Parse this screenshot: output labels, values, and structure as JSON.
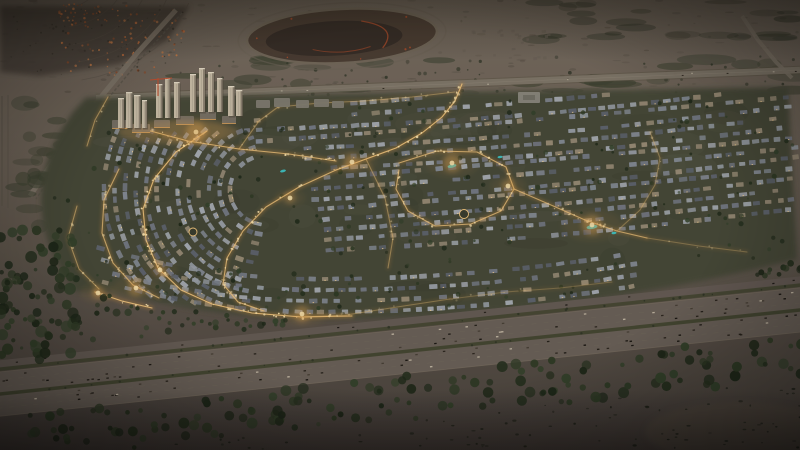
{
  "image": {
    "kind": "aerial-photograph-render",
    "subject": "illuminated master-planned villa community at dusk",
    "environment": "desert plain, dirt oval track at top, multi-lane highway and tree belt in foreground",
    "width": 800,
    "height": 450
  },
  "palette": {
    "desert_top": "#776c60",
    "desert_mid": "#6e6357",
    "desert_low": "#5e554b",
    "desert_bottom": "#49413c",
    "desert_speckle": "#3e382e",
    "scrub_green": "#3d4230",
    "scrub_dark": "#2d3324",
    "distant_base": "#4a4138",
    "distant_roofs": [
      "#c4703f",
      "#a85c33",
      "#8f4f2e",
      "#d08049"
    ],
    "track_ring": "#756a5b",
    "track_fill": "#4a3c32",
    "track_inner": "#382e28",
    "track_accent": "#b44f2c",
    "road_gray": "#83796c",
    "road_edge": "#948a7c",
    "rail_gray": "#5d564b",
    "community_ground": "#474a38",
    "ground_light": "#565947",
    "ground_dark": "#3a3d2e",
    "warm_ground": "#8a703f",
    "roof_grays": [
      "#9aa0a8",
      "#868c96",
      "#767b86",
      "#a8adb4",
      "#5f646e",
      "#9a8d77"
    ],
    "window_warm": "#ffd894",
    "street_amber": "#c98f3f",
    "street_bright": "#ffcf82",
    "street_dot": "#ffe7b0",
    "glow_amber": "#e8a855",
    "tree_greens": [
      "#26301e",
      "#1e2818",
      "#2e3a24",
      "#34422a"
    ],
    "pool_teal": "#3fc8c8",
    "tower_light": "#cbbfa9",
    "tower_shade": "#8d8271",
    "tower_cap": "#e6ddc8",
    "podium": "#7b7366",
    "midrise": "#827d72",
    "school": "#8d8a80",
    "crane_red": "#c9502e",
    "asphalt": "#6b6158",
    "asphalt_edge": "#7d7264",
    "median_green": "#43462f",
    "frontage": "#665d55",
    "car_darks": [
      "#17130f",
      "#221d17",
      "#2a241c"
    ],
    "car_mid": "#473e35",
    "car_light": "#c7bca8",
    "sand_patch": "#5a5045",
    "vignette": "#000000"
  },
  "features": {
    "seed": 11,
    "distant_community": {
      "roof_count": 170,
      "region": [
        [
          0,
          6
        ],
        [
          190,
          6
        ],
        [
          168,
          40
        ],
        [
          120,
          64
        ],
        [
          40,
          76
        ],
        [
          0,
          72
        ]
      ]
    },
    "dirt_track": {
      "cx": 342,
      "cy": 36,
      "rx": 95,
      "ry": 27,
      "structures": 22
    },
    "top_road": {
      "from": [
        96,
        98
      ],
      "to": [
        800,
        70
      ],
      "cars": 12
    },
    "left_road": [
      [
        176,
        10
      ],
      [
        138,
        52
      ],
      [
        100,
        98
      ],
      [
        62,
        148
      ],
      [
        30,
        196
      ]
    ],
    "right_road": [
      [
        742,
        16
      ],
      [
        758,
        40
      ],
      [
        776,
        62
      ],
      [
        792,
        78
      ]
    ],
    "towers": {
      "clusters": [
        {
          "baseY": 128,
          "towers": [
            [
              118,
              30
            ],
            [
              126,
              36
            ],
            [
              134,
              33
            ],
            [
              142,
              28
            ]
          ]
        },
        {
          "baseY": 118,
          "towers": [
            [
              156,
              34
            ],
            [
              165,
              40
            ],
            [
              174,
              36
            ]
          ]
        },
        {
          "baseY": 112,
          "towers": [
            [
              190,
              38
            ],
            [
              199,
              44
            ],
            [
              208,
              40
            ],
            [
              217,
              34
            ]
          ]
        },
        {
          "baseY": 116,
          "towers": [
            [
              228,
              30
            ],
            [
              236,
              26
            ]
          ]
        }
      ],
      "crane": [
        158,
        96
      ]
    },
    "podium_blocks": [
      [
        112,
        120,
        16,
        9
      ],
      [
        132,
        124,
        18,
        9
      ],
      [
        154,
        120,
        16,
        8
      ],
      [
        176,
        116,
        18,
        9
      ],
      [
        200,
        112,
        16,
        8
      ],
      [
        222,
        116,
        14,
        8
      ]
    ],
    "midrise_blocks": [
      [
        256,
        100,
        14,
        8
      ],
      [
        274,
        98,
        16,
        9
      ],
      [
        296,
        100,
        13,
        8
      ],
      [
        314,
        99,
        15,
        8
      ],
      [
        332,
        101,
        12,
        7
      ]
    ],
    "school_block": [
      518,
      92,
      22,
      11
    ],
    "community": {
      "row_step": 10.3,
      "arc_center": [
        268,
        190
      ],
      "tree_count": 330,
      "mottle_count": 60
    },
    "lit_streets": [
      {
        "lv": 1.0,
        "pts": [
          [
            462,
            84
          ],
          [
            455,
            101
          ],
          [
            442,
            117
          ],
          [
            422,
            133
          ],
          [
            396,
            148
          ],
          [
            366,
            159
          ],
          [
            336,
            170
          ]
        ]
      },
      {
        "lv": 0.9,
        "pts": [
          [
            336,
            170
          ],
          [
            299,
            187
          ],
          [
            266,
            207
          ],
          [
            243,
            231
          ],
          [
            227,
            258
          ],
          [
            223,
            284
          ],
          [
            238,
            302
          ],
          [
            264,
            311
          ]
        ]
      },
      {
        "lv": 1.0,
        "pts": [
          [
            207,
            131
          ],
          [
            176,
            152
          ],
          [
            154,
            179
          ],
          [
            143,
            209
          ],
          [
            146,
            240
          ],
          [
            158,
            268
          ],
          [
            181,
            290
          ],
          [
            212,
            304
          ],
          [
            252,
            313
          ],
          [
            302,
            317
          ],
          [
            352,
            316
          ]
        ]
      },
      {
        "lv": 0.8,
        "pts": [
          [
            119,
            169
          ],
          [
            104,
            200
          ],
          [
            102,
            233
          ],
          [
            113,
            263
          ],
          [
            133,
            285
          ],
          [
            159,
            298
          ]
        ]
      },
      {
        "lv": 0.6,
        "pts": [
          [
            77,
            206
          ],
          [
            68,
            238
          ],
          [
            79,
            269
          ],
          [
            99,
            289
          ]
        ]
      },
      {
        "lv": 0.9,
        "pts": [
          [
            143,
            129
          ],
          [
            188,
            141
          ],
          [
            239,
            149
          ],
          [
            289,
            154
          ],
          [
            336,
            161
          ]
        ]
      },
      {
        "lv": 0.85,
        "pts": [
          [
            399,
            163
          ],
          [
            437,
            151
          ],
          [
            477,
            152
          ],
          [
            506,
            167
          ],
          [
            514,
            189
          ],
          [
            501,
            211
          ],
          [
            471,
            224
          ],
          [
            435,
            226
          ],
          [
            408,
            211
          ],
          [
            396,
            189
          ],
          [
            399,
            170
          ]
        ]
      },
      {
        "lv": 0.8,
        "pts": [
          [
            514,
            189
          ],
          [
            551,
            205
          ],
          [
            585,
            220
          ],
          [
            617,
            231
          ],
          [
            647,
            238
          ]
        ]
      },
      {
        "lv": 0.35,
        "pts": [
          [
            647,
            238
          ],
          [
            699,
            246
          ],
          [
            747,
            252
          ]
        ]
      },
      {
        "lv": 0.4,
        "pts": [
          [
            302,
            317
          ],
          [
            346,
            315
          ],
          [
            397,
            307
          ],
          [
            450,
            299
          ]
        ]
      },
      {
        "lv": 0.5,
        "pts": [
          [
            366,
            159
          ],
          [
            385,
            198
          ],
          [
            393,
            238
          ],
          [
            388,
            268
          ]
        ]
      },
      {
        "lv": 0.5,
        "pts": [
          [
            239,
            149
          ],
          [
            259,
            121
          ],
          [
            278,
            107
          ]
        ]
      },
      {
        "lv": 0.6,
        "pts": [
          [
            108,
            97
          ],
          [
            95,
            120
          ],
          [
            87,
            146
          ]
        ]
      },
      {
        "lv": 1.0,
        "pts": [
          [
            95,
            292
          ],
          [
            122,
            301
          ],
          [
            152,
            308
          ]
        ]
      },
      {
        "lv": 0.3,
        "pts": [
          [
            450,
            299
          ],
          [
            506,
            292
          ],
          [
            560,
            288
          ],
          [
            612,
            282
          ]
        ]
      },
      {
        "lv": 0.45,
        "pts": [
          [
            278,
            107
          ],
          [
            320,
            103
          ],
          [
            364,
            101
          ],
          [
            412,
            97
          ],
          [
            455,
            92
          ]
        ]
      },
      {
        "lv": 0.4,
        "pts": [
          [
            617,
            231
          ],
          [
            640,
            210
          ],
          [
            655,
            185
          ],
          [
            660,
            158
          ],
          [
            650,
            132
          ]
        ]
      }
    ],
    "roundabouts": [
      [
        464,
        214,
        4.5
      ],
      [
        193,
        232,
        4
      ]
    ],
    "pools": [
      [
        452,
        166,
        9,
        3.5,
        -12
      ],
      [
        592,
        227,
        11,
        4,
        -8
      ],
      [
        283,
        171,
        6,
        2.6,
        -15
      ],
      [
        614,
        233,
        5,
        2.4,
        -8
      ],
      [
        500,
        157,
        5,
        2.4,
        -10
      ]
    ],
    "amenity_glows": [
      [
        196,
        132,
        10
      ],
      [
        352,
        162,
        8
      ],
      [
        452,
        163,
        9
      ],
      [
        592,
        225,
        10
      ],
      [
        136,
        288,
        8
      ],
      [
        302,
        314,
        8
      ],
      [
        98,
        293,
        6
      ],
      [
        508,
        186,
        6
      ],
      [
        290,
        198,
        5
      ],
      [
        160,
        270,
        6
      ]
    ],
    "highway": {
      "center_from": [
        0,
        394
      ],
      "center_to": [
        800,
        310
      ],
      "width": 44,
      "frontage_offset": -30,
      "car_count": 118,
      "frontage_cars": 10
    },
    "tree_band": {
      "offset_min": 24,
      "offset_max": 68,
      "count": 150
    },
    "corner_forest": {
      "count": 70
    },
    "shrub_count": 210,
    "desert_speckles": 150,
    "scrub_patches": 30
  }
}
